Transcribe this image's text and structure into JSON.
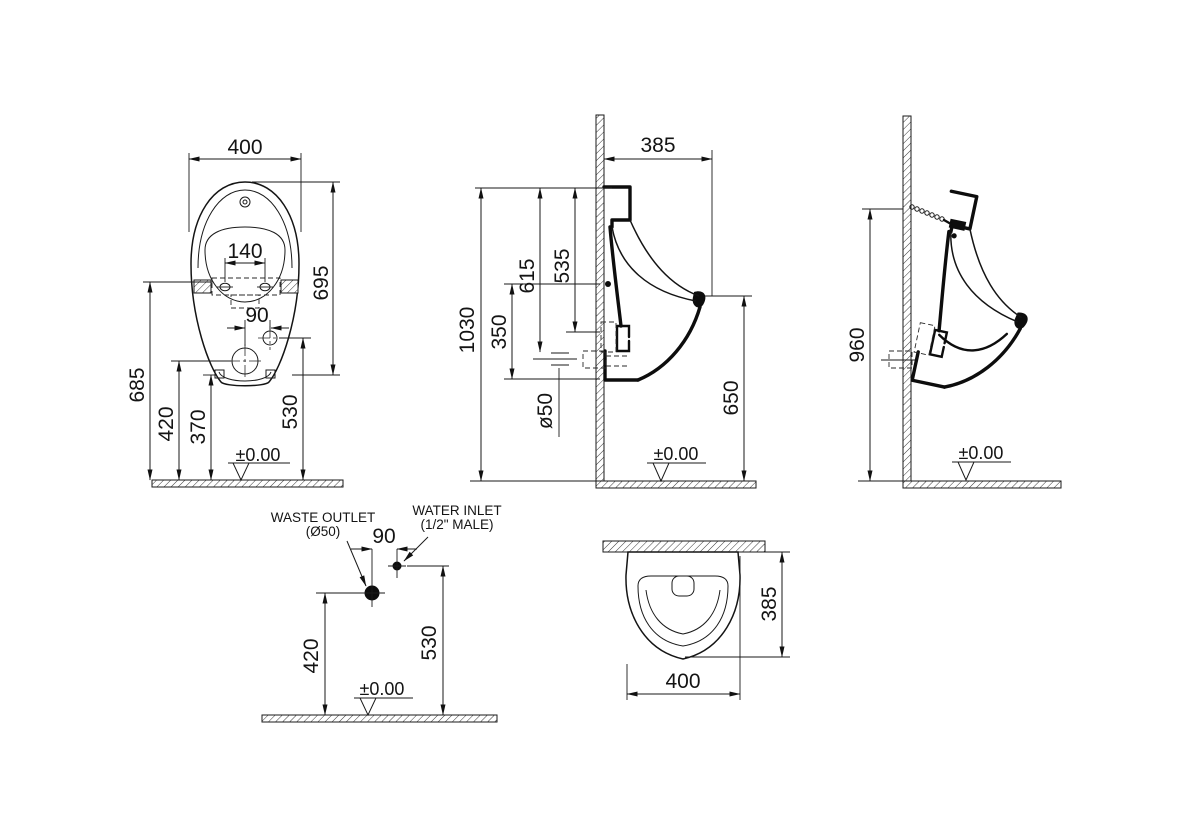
{
  "views": {
    "front": {
      "overall_width": "400",
      "mounting_hole_spacing": "140",
      "inlet_offset": "90",
      "body_height": "695",
      "mounting_height": "685",
      "waste_outlet_height": "420",
      "body_bottom_height": "370",
      "water_inlet_height": "530",
      "floor_datum": "±0.00"
    },
    "side": {
      "depth_from_wall": "385",
      "overall_height": "1030",
      "top_to_outlet": "615",
      "top_to_spud": "535",
      "fixing_to_bottom": "350",
      "waste_pipe_diameter": "ø50",
      "rim_height": "650",
      "floor_datum": "±0.00"
    },
    "installation": {
      "hanger_height": "960",
      "floor_datum": "±0.00"
    },
    "connections": {
      "waste_outlet_label": "WASTE OUTLET",
      "waste_outlet_size": "(Ø50)",
      "water_inlet_label": "WATER INLET",
      "water_inlet_size": "(1/2\" MALE)",
      "horizontal_offset": "90",
      "waste_outlet_height": "420",
      "water_inlet_height": "530",
      "floor_datum": "±0.00"
    },
    "plan": {
      "depth": "385",
      "width": "400"
    }
  }
}
